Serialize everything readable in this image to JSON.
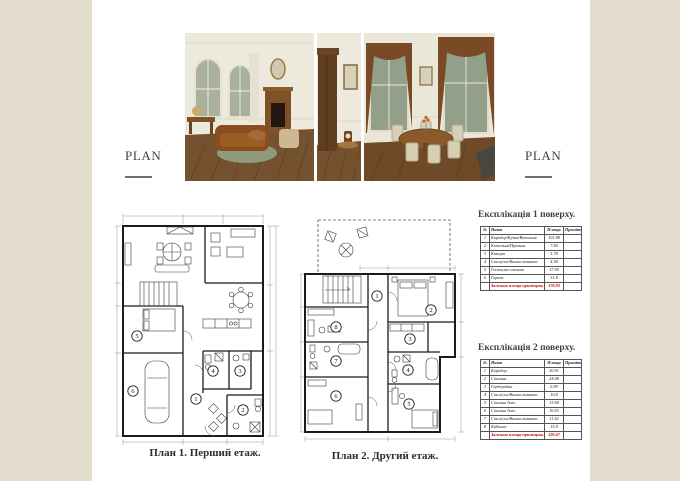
{
  "colors": {
    "background": "#e2ddcc",
    "paper": "#ffffff",
    "accent_text": "#4a433c",
    "total_red": "#c40000"
  },
  "plan_label_left": "PLAN",
  "plan_label_right": "PLAN",
  "renders": {
    "items": [
      {
        "name": "living-room-render"
      },
      {
        "name": "hall-cabinet-render"
      },
      {
        "name": "dining-room-render"
      }
    ]
  },
  "plans": {
    "plan1": {
      "caption": "План 1. Перший етаж.",
      "room_numbers": [
        "1",
        "2",
        "3",
        "4",
        "5",
        "6"
      ]
    },
    "plan2": {
      "caption": "План 2. Другий етаж.",
      "room_numbers": [
        "1",
        "2",
        "3",
        "4",
        "5",
        "6",
        "7",
        "8"
      ]
    }
  },
  "tables": [
    {
      "title": "Експлікація 1 поверху.",
      "columns": [
        "№",
        "Назва",
        "Площа",
        "Примітка"
      ],
      "rows": [
        [
          "1",
          "Коридор/Кухня/Вітальня",
          "101.88",
          ""
        ],
        [
          "2",
          "Котельня/Пральня",
          "7.84",
          ""
        ],
        [
          "3",
          "Комора",
          "5.78",
          ""
        ],
        [
          "4",
          "Сан.вузол/Ванна кімната",
          "4.58",
          ""
        ],
        [
          "5",
          "Гостьова спальня",
          "17.95",
          ""
        ],
        [
          "6",
          "Гараж",
          "31.8",
          ""
        ]
      ],
      "total": {
        "label": "Загальна площа приміщень",
        "value": "170.93",
        "note": ""
      }
    },
    {
      "title": "Експлікація 2 поверху.",
      "columns": [
        "№",
        "Назва",
        "Площа",
        "Примітка"
      ],
      "rows": [
        [
          "1",
          "Коридор",
          "20.91",
          ""
        ],
        [
          "2",
          "Спальня",
          "24.08",
          ""
        ],
        [
          "3",
          "Гардеробна",
          "6.89",
          ""
        ],
        [
          "4",
          "Сан.вузол/Ванна кімната",
          "10.8",
          ""
        ],
        [
          "5",
          "Спальня дит.",
          "13.84",
          ""
        ],
        [
          "6",
          "Спальня дит.",
          "16.93",
          ""
        ],
        [
          "7",
          "Сан.вузол/Ванна кімната",
          "11.42",
          ""
        ],
        [
          "8",
          "Кабінет",
          "15.8",
          ""
        ]
      ],
      "total": {
        "label": "Загальна площа приміщень",
        "value": "120.67",
        "note": ""
      }
    }
  ]
}
